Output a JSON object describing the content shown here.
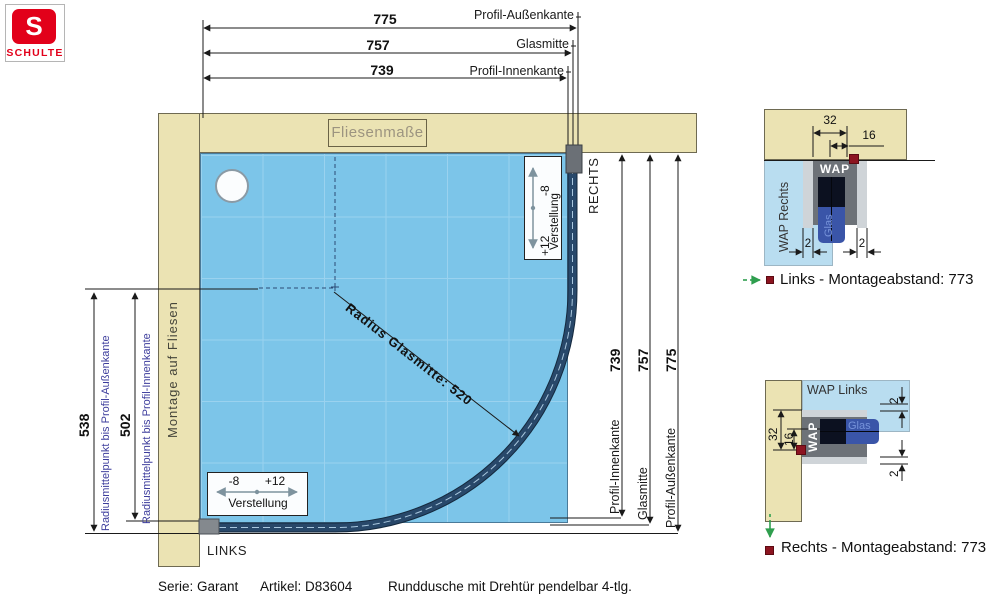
{
  "logo": {
    "s": "S",
    "brand": "SCHULTE"
  },
  "drawing": {
    "tile_label": "Fliesenmaße",
    "wall_label": "Montage auf Fliesen",
    "corner_left": "LINKS",
    "corner_right": "RECHTS",
    "radius_label": "Radius Glasmitte: 520",
    "dims": {
      "aussenkante": "775",
      "glasmitte": "757",
      "innenkante": "739",
      "label_aussenkante": "Profil-Außenkante",
      "label_glasmitte": "Glasmitte",
      "label_innenkante": "Profil-Innenkante",
      "radius_to_aussen": "538",
      "radius_to_innen": "502",
      "label_radius_aussen": "Radiusmittelpunkt bis Profil-Außenkante",
      "label_radius_innen": "Radiusmittelpunkt bis Profil-Innenkante"
    },
    "verstellung": {
      "label": "Verstellung",
      "minus": "-8",
      "plus": "+12"
    }
  },
  "details": {
    "wap": "WAP",
    "glas": "Glas",
    "dim_32": "32",
    "dim_16": "16",
    "dim_2": "2",
    "top": {
      "area_label": "WAP Rechts",
      "caption": "Links - Montageabstand: 773"
    },
    "bottom": {
      "area_label": "WAP Links",
      "caption": "Rechts - Montageabstand: 773"
    }
  },
  "footer": {
    "serie": "Serie: Garant",
    "artikel": "Artikel: D83604",
    "description": "Runddusche mit Drehtür pendelbar 4-tlg."
  },
  "colors": {
    "wall": "#ebe3b3",
    "floor": "#7cc5e9",
    "grid": "#9ad2ef",
    "glass": "#28486a",
    "profile_gray": "#6d7278",
    "detail_light_blue": "#b9ddf0",
    "label_blue": "#3c3c9c",
    "marker_red": "#8c1420",
    "arrow_green": "#2f9e4e",
    "logo_red": "#e2001a"
  }
}
